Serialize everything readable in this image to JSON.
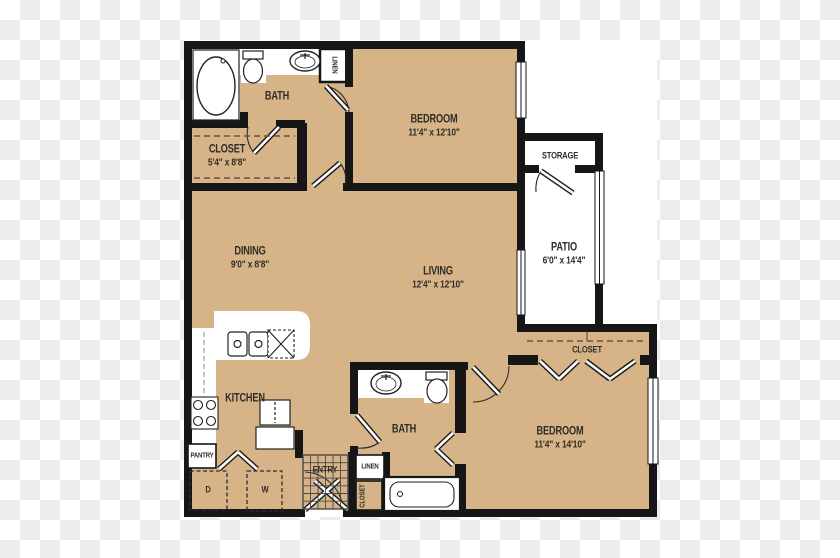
{
  "title": "Two-bedroom apartment floor plan",
  "colors": {
    "floor": "#d7b487",
    "wall": "#161616",
    "paper": "#ffffff",
    "checker_dark": "#ececec",
    "label_text": "#2f2d28",
    "closet_dash": "#6b5534"
  },
  "rooms": {
    "bath1": {
      "name": "BATH"
    },
    "closet1": {
      "name": "CLOSET",
      "dims": "5'4\" x 8'8\""
    },
    "bedroom1": {
      "name": "BEDROOM",
      "dims": "11'4\" x 12'10\""
    },
    "linen_top": {
      "name": "LINEN"
    },
    "storage": {
      "name": "STORAGE"
    },
    "patio": {
      "name": "PATIO",
      "dims": "6'0\" x 14'4\""
    },
    "dining": {
      "name": "DINING",
      "dims": "9'0\" x 8'8\""
    },
    "living": {
      "name": "LIVING",
      "dims": "12'4\" x 12'10\""
    },
    "kitchen": {
      "name": "KITCHEN"
    },
    "pantry": {
      "name": "PANTRY"
    },
    "dryer": {
      "name": "D"
    },
    "washer": {
      "name": "W"
    },
    "entry": {
      "name": "ENTRY"
    },
    "linen_hall": {
      "name": "LINEN"
    },
    "closet_hall": {
      "name": "CLOSET"
    },
    "bath2": {
      "name": "BATH"
    },
    "closet2": {
      "name": "CLOSET"
    },
    "bedroom2": {
      "name": "BEDROOM",
      "dims": "11'4\" x 14'10\""
    }
  }
}
